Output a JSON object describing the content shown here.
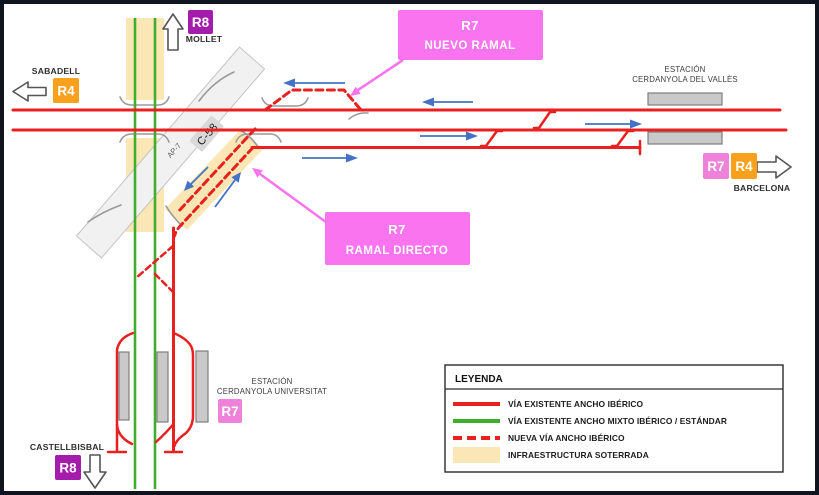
{
  "labels": {
    "sabadell": "SABADELL",
    "mollet": "MOLLET",
    "barcelona": "BARCELONA",
    "castellbisbal": "CASTELLBISBAL",
    "ap7": "AP-7",
    "c58": "C-58"
  },
  "stations": {
    "valles_line1": "ESTACIÓN",
    "valles_line2": "CERDANYOLA DEL VALLÈS",
    "universitat_line1": "ESTACIÓN",
    "universitat_line2": "CERDANYOLA UNIVERSITAT"
  },
  "badges": {
    "mollet_r8": "R8",
    "sabadell_r4": "R4",
    "barcelona_r7": "R7",
    "barcelona_r4": "R4",
    "universitat_r7": "R7",
    "castellbisbal_r8": "R8"
  },
  "callouts": {
    "nuevo_ramal_line1": "R7",
    "nuevo_ramal_line2": "NUEVO RAMAL",
    "ramal_directo_line1": "R7",
    "ramal_directo_line2": "RAMAL DIRECTO"
  },
  "legend": {
    "title": "LEYENDA",
    "items": [
      {
        "swatch": "red-solid-line",
        "label": "VÍA EXISTENTE ANCHO IBÉRICO"
      },
      {
        "swatch": "green-solid-line",
        "label": "VÍA EXISTENTE ANCHO MIXTO IBÉRICO / ESTÁNDAR"
      },
      {
        "swatch": "red-dashed-line",
        "label": "NUEVA VÍA ANCHO IBÉRICO"
      },
      {
        "swatch": "beige-area",
        "label": "INFRAESTRUCTURA SOTERRADA"
      }
    ]
  },
  "colors": {
    "track_red": "#e8201f",
    "track_green": "#3fae2c",
    "underground_beige": "#fae7b5",
    "callout_pink": "#fa74ef",
    "badge_pink": "#ee82d8",
    "badge_orange": "#f9a11d",
    "badge_purple": "#a41cac",
    "arrow_blue": "#4472c4",
    "highway_gray": "#f1f1f1"
  }
}
